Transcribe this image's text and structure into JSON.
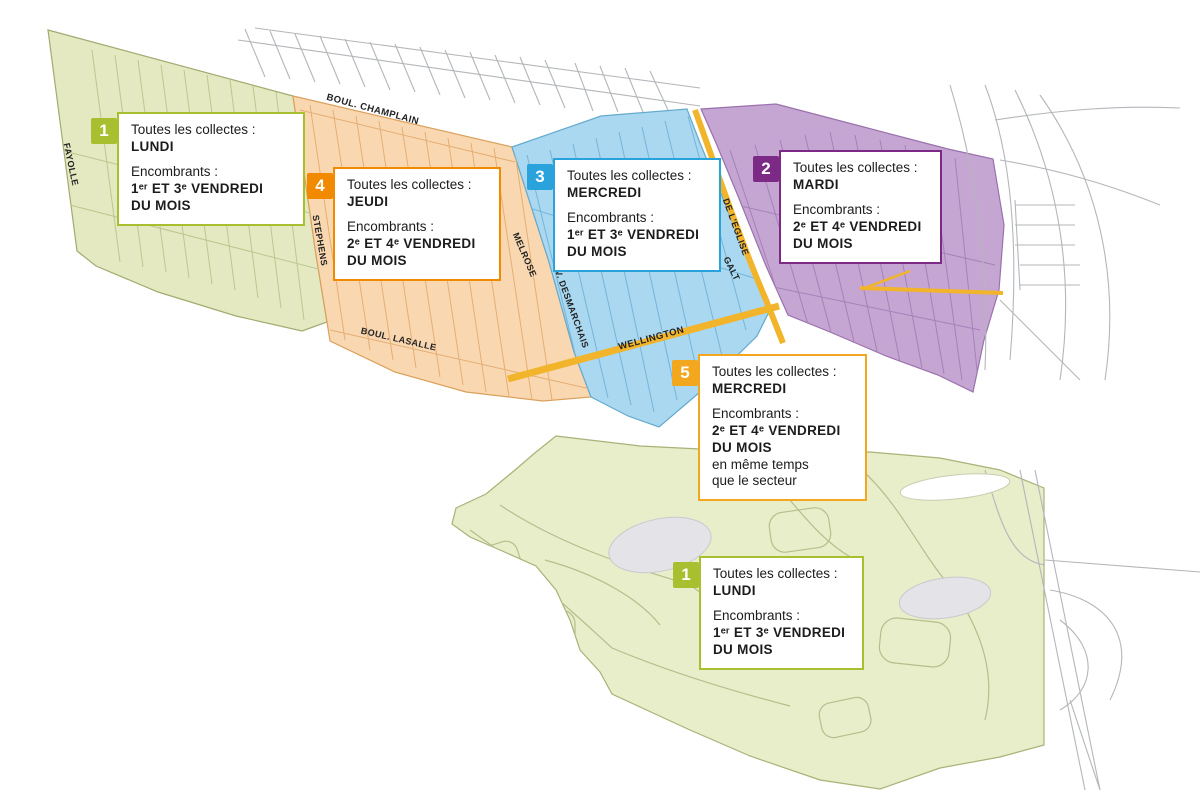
{
  "labels": {
    "collections": "Toutes les collectes :",
    "bulky": "Encombrants :"
  },
  "sectors": [
    {
      "id": "1",
      "color": "#a8bf2f",
      "day": "LUNDI",
      "bulky_schedule": "1ᵉʳ ET 3ᵉ VENDREDI DU MOIS",
      "note": ""
    },
    {
      "id": "4",
      "color": "#f28a00",
      "day": "JEUDI",
      "bulky_schedule": "2ᵉ ET 4ᵉ VENDREDI DU MOIS",
      "note": ""
    },
    {
      "id": "3",
      "color": "#2aa2dc",
      "day": "MERCREDI",
      "bulky_schedule": "1ᵉʳ ET 3ᵉ VENDREDI DU MOIS",
      "note": ""
    },
    {
      "id": "2",
      "color": "#7c2a85",
      "day": "MARDI",
      "bulky_schedule": "2ᵉ ET 4ᵉ VENDREDI DU MOIS",
      "note": ""
    },
    {
      "id": "5",
      "color": "#f2a71e",
      "day": "MERCREDI",
      "bulky_schedule": "2ᵉ ET 4ᵉ VENDREDI DU MOIS",
      "note": "en même temps que le secteur"
    },
    {
      "id": "1",
      "color": "#a8bf2f",
      "day": "LUNDI",
      "bulky_schedule": "1ᵉʳ ET 3ᵉ VENDREDI DU MOIS",
      "note": ""
    }
  ],
  "streets": [
    {
      "name": "FAYOLLE"
    },
    {
      "name": "BOUL. CHAMPLAIN"
    },
    {
      "name": "STEPHENS"
    },
    {
      "name": "MELROSE"
    },
    {
      "name": "AV. DESMARCHAIS"
    },
    {
      "name": "BOUL. LASALLE"
    },
    {
      "name": "WELLINGTON"
    },
    {
      "name": "DE L'EGLISE"
    },
    {
      "name": "GALT"
    }
  ],
  "colors": {
    "sector1_fill": "#e4e9c1",
    "sector1_edge": "#a2ab70",
    "sector4_fill": "#f9d8b1",
    "sector4_edge": "#dba05c",
    "sector3_fill": "#a9d8f0",
    "sector3_edge": "#64aacd",
    "sector2_fill": "#c5a5d2",
    "sector2_edge": "#9a71ad",
    "island_fill": "#e8edca",
    "island_edge": "#a9b277",
    "road_highlight": "#f2b42a",
    "minor_road": "#b3b6ba",
    "pond": "#e4e4e8"
  }
}
